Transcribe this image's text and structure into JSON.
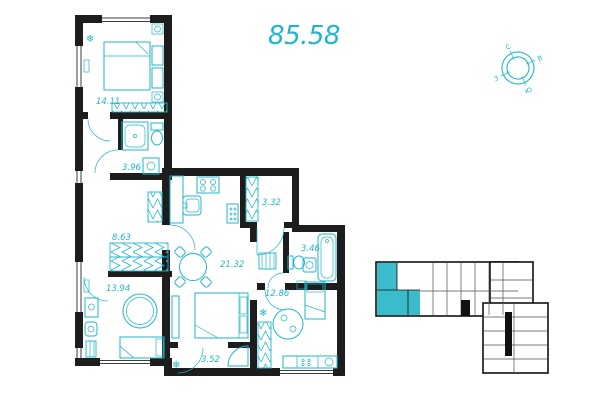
{
  "title": {
    "total_area": "85.58"
  },
  "compass": {
    "north": "С",
    "east": "В",
    "south": "Ю",
    "west": "З"
  },
  "icons": {
    "snowflake": "❄"
  },
  "colors": {
    "accent": "#1fb6cb",
    "wall": "#1d1d1d",
    "minimap_highlight": "#3bbccb"
  },
  "rooms": [
    {
      "name": "bedroom-1",
      "area": "14.11"
    },
    {
      "name": "bathroom-1",
      "area": "3.96"
    },
    {
      "name": "hallway",
      "area": "8.63"
    },
    {
      "name": "bedroom-2",
      "area": "13.94"
    },
    {
      "name": "living-room",
      "area": "21.32"
    },
    {
      "name": "wardrobe",
      "area": "3.32"
    },
    {
      "name": "bathroom-2",
      "area": "3.46"
    },
    {
      "name": "corridor",
      "area": "3.52"
    },
    {
      "name": "kitchen-living",
      "area": "12.86"
    }
  ]
}
